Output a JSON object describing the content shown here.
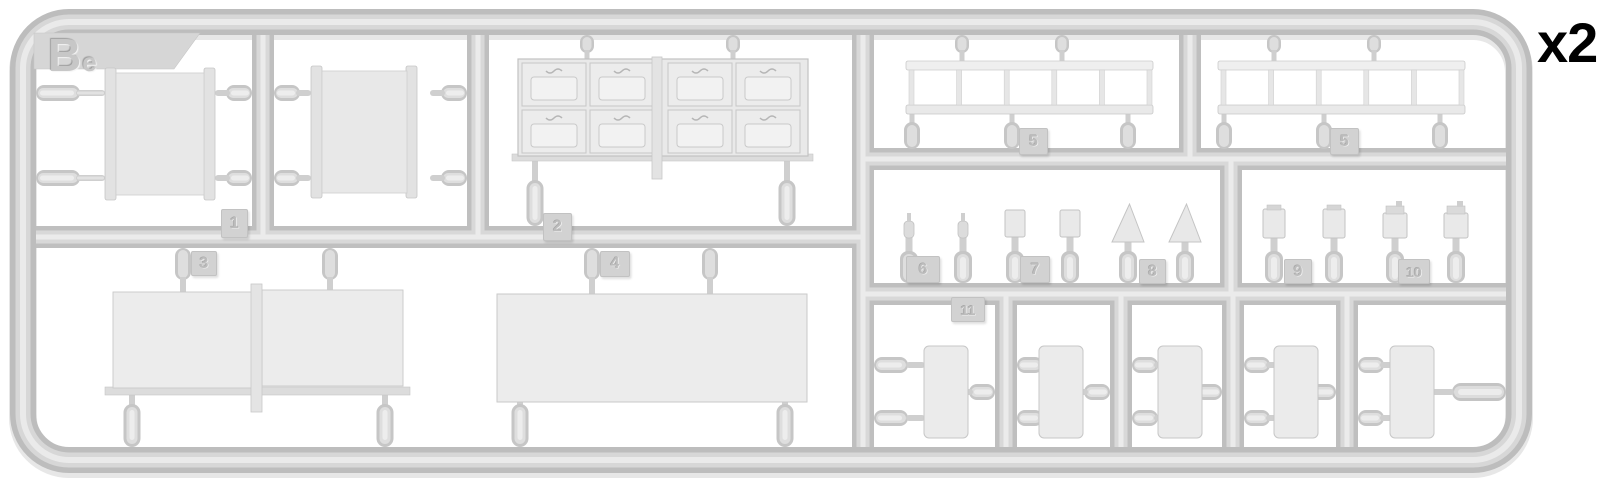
{
  "sprue": {
    "letter": "Be",
    "quantity_marker": "x2",
    "part_numbers": {
      "n1": "1",
      "n2": "2",
      "n3": "3",
      "n4": "4",
      "n5": "5",
      "n6": "6",
      "n7": "7",
      "n8": "8",
      "n9": "9",
      "n10": "10",
      "n11": "11"
    },
    "colors": {
      "background": "#ffffff",
      "plastic_base": "#bdbdbd",
      "plastic_mid": "#d8d8d8",
      "plastic_highlight": "#ebebeb",
      "part_fill": "#ececec",
      "tag_fill": "#d2d2d2",
      "marker_text": "#000000"
    }
  }
}
